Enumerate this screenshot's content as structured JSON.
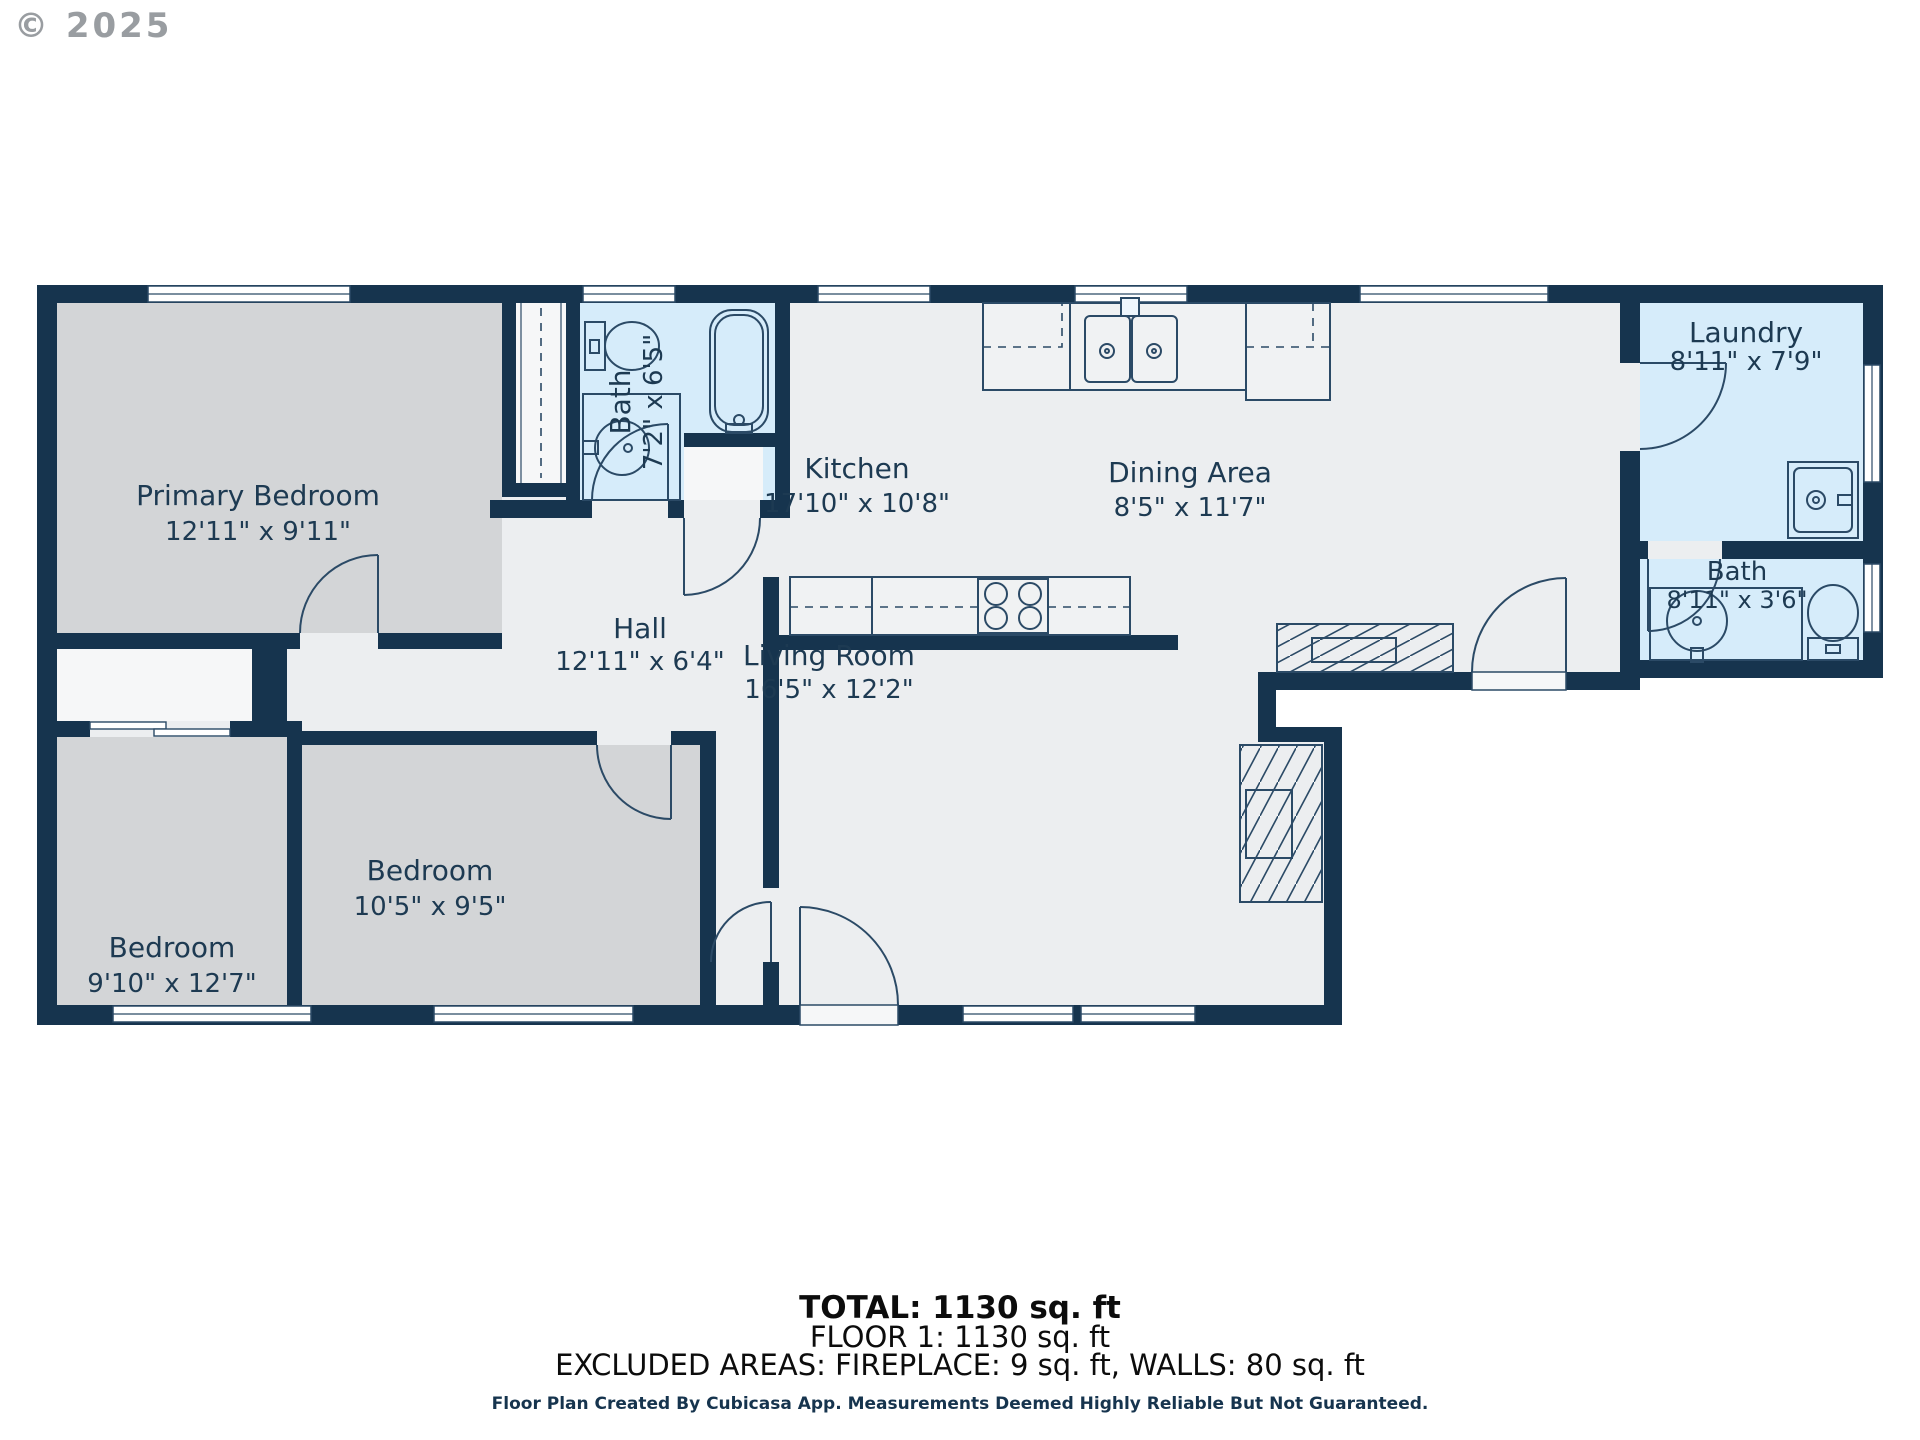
{
  "copyright": "© 2025",
  "rooms": {
    "primary": {
      "name": "Primary Bedroom",
      "dims": "12'11\" x 9'11\""
    },
    "bath_upper": {
      "name": "Bath",
      "dims": "7'2\" x 6'5\""
    },
    "kitchen": {
      "name": "Kitchen",
      "dims": "17'10\" x 10'8\""
    },
    "dining": {
      "name": "Dining Area",
      "dims": "8'5\" x 11'7\""
    },
    "laundry": {
      "name": "Laundry",
      "dims": "8'11\" x 7'9\""
    },
    "bath_right": {
      "name": "Bath",
      "dims": "8'11\" x 3'6\""
    },
    "hall": {
      "name": "Hall",
      "dims": "12'11\" x 6'4\""
    },
    "bedroom_left": {
      "name": "Bedroom",
      "dims": "9'10\" x 12'7\""
    },
    "bedroom_mid": {
      "name": "Bedroom",
      "dims": "10'5\" x 9'5\""
    },
    "living": {
      "name": "Living Room",
      "dims": "16'5\" x 12'2\""
    }
  },
  "summary": {
    "total": "TOTAL: 1130 sq. ft",
    "floor": "FLOOR 1: 1130 sq. ft",
    "excluded": "EXCLUDED AREAS: FIREPLACE: 9 sq. ft, WALLS: 80 sq. ft",
    "disclaimer": "Floor Plan Created By Cubicasa App. Measurements Deemed Highly Reliable But Not Guaranteed."
  },
  "colors": {
    "wall": "#16344e",
    "floor_light": "#eceef0",
    "bedroom_gray": "#d3d5d7",
    "wet_room_blue": "#d6ecfa",
    "closet_white": "#f6f7f8"
  }
}
